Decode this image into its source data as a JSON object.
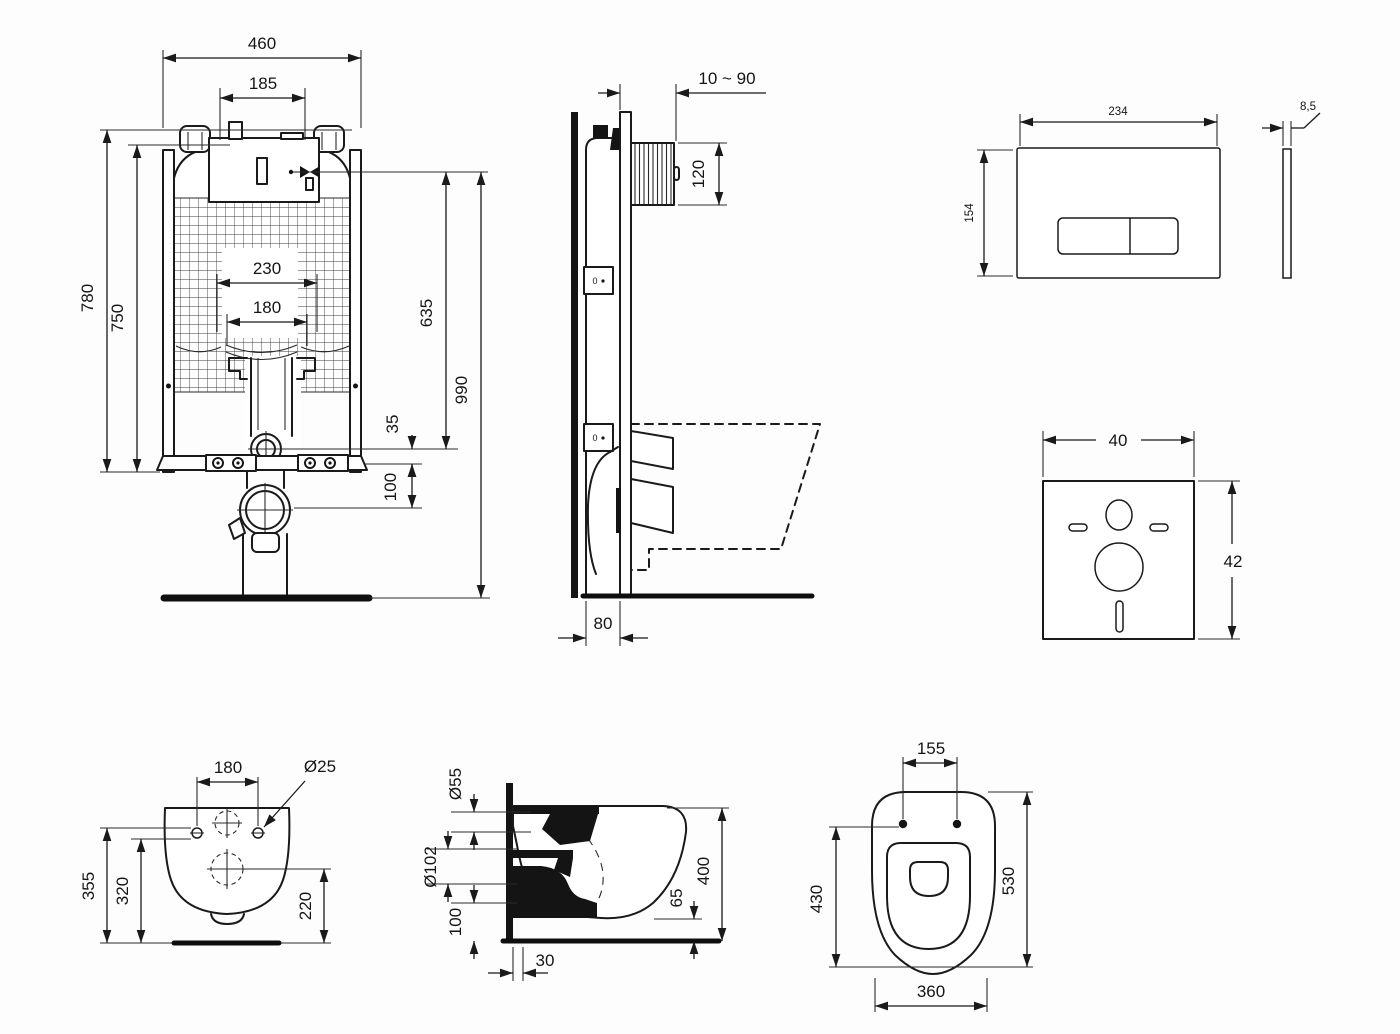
{
  "colors": {
    "line": "#1a1a1a",
    "background": "#ffffff",
    "section_fill": "#141414"
  },
  "views": {
    "frame_front": {
      "w460": "460",
      "w185": "185",
      "h780": "780",
      "h750": "750",
      "w230": "230",
      "w180": "180",
      "h635": "635",
      "h990": "990",
      "o35": "35",
      "o100": "100"
    },
    "frame_side": {
      "range": "10 ~ 90",
      "h120": "120",
      "d80": "80",
      "fix": "0"
    },
    "plate_front": {
      "w234": "234",
      "h154": "154"
    },
    "plate_side": {
      "t85": "8,5"
    },
    "mat": {
      "w40": "40",
      "h42": "42"
    },
    "wc_rear": {
      "w180": "180",
      "d25": "Ø25",
      "h355": "355",
      "h320": "320",
      "h220": "220"
    },
    "wc_side": {
      "d55": "Ø55",
      "d102": "Ø102",
      "h100": "100",
      "d30": "30",
      "h65": "65",
      "h400": "400"
    },
    "wc_top": {
      "w155": "155",
      "l530": "530",
      "w430": "430",
      "w360": "360"
    }
  }
}
